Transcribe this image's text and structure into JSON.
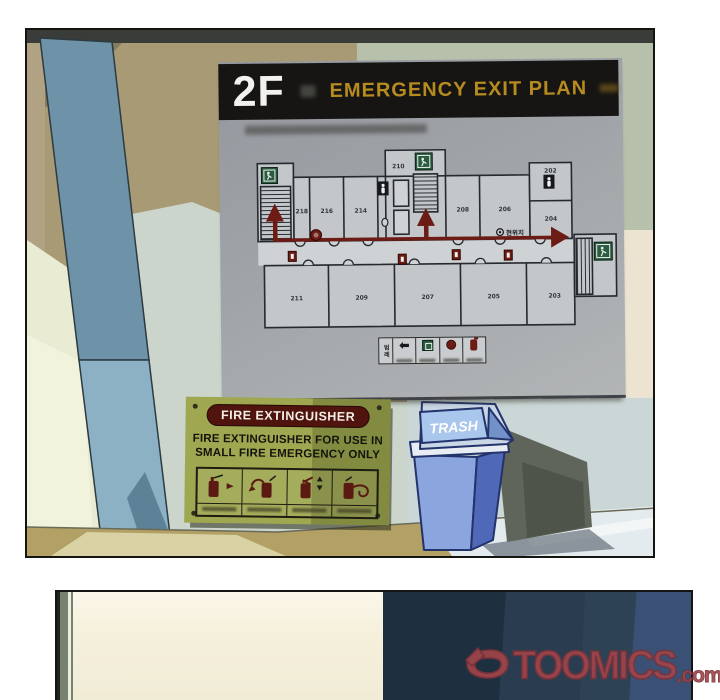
{
  "panel1": {
    "exit_plan_board": {
      "floor_label": "2F",
      "title": "EMERGENCY EXIT PLAN",
      "rooms_top": [
        "218",
        "216",
        "214",
        "210",
        "208",
        "206",
        "202",
        "204"
      ],
      "rooms_bottom": [
        "211",
        "209",
        "207",
        "205",
        "203"
      ],
      "current_location": "현위치",
      "legend_title": "범례"
    },
    "fire_extinguisher_sign": {
      "banner": "FIRE EXTINGUISHER",
      "line1": "FIRE EXTINGUISHER FOR USE IN",
      "line2": "SMALL FIRE EMERGENCY ONLY"
    },
    "trash_can": {
      "label": "TRASH"
    }
  },
  "watermark": {
    "brand": "TOOMICS",
    "suffix": ".com"
  },
  "colors": {
    "title_gold": "#b78c1e",
    "exit_green": "#2b5b41",
    "evac_maroon": "#6d1c15",
    "sign_olive": "#9fa851",
    "trash_blue": "#8ba6de",
    "logo_red": "#a2444a"
  }
}
